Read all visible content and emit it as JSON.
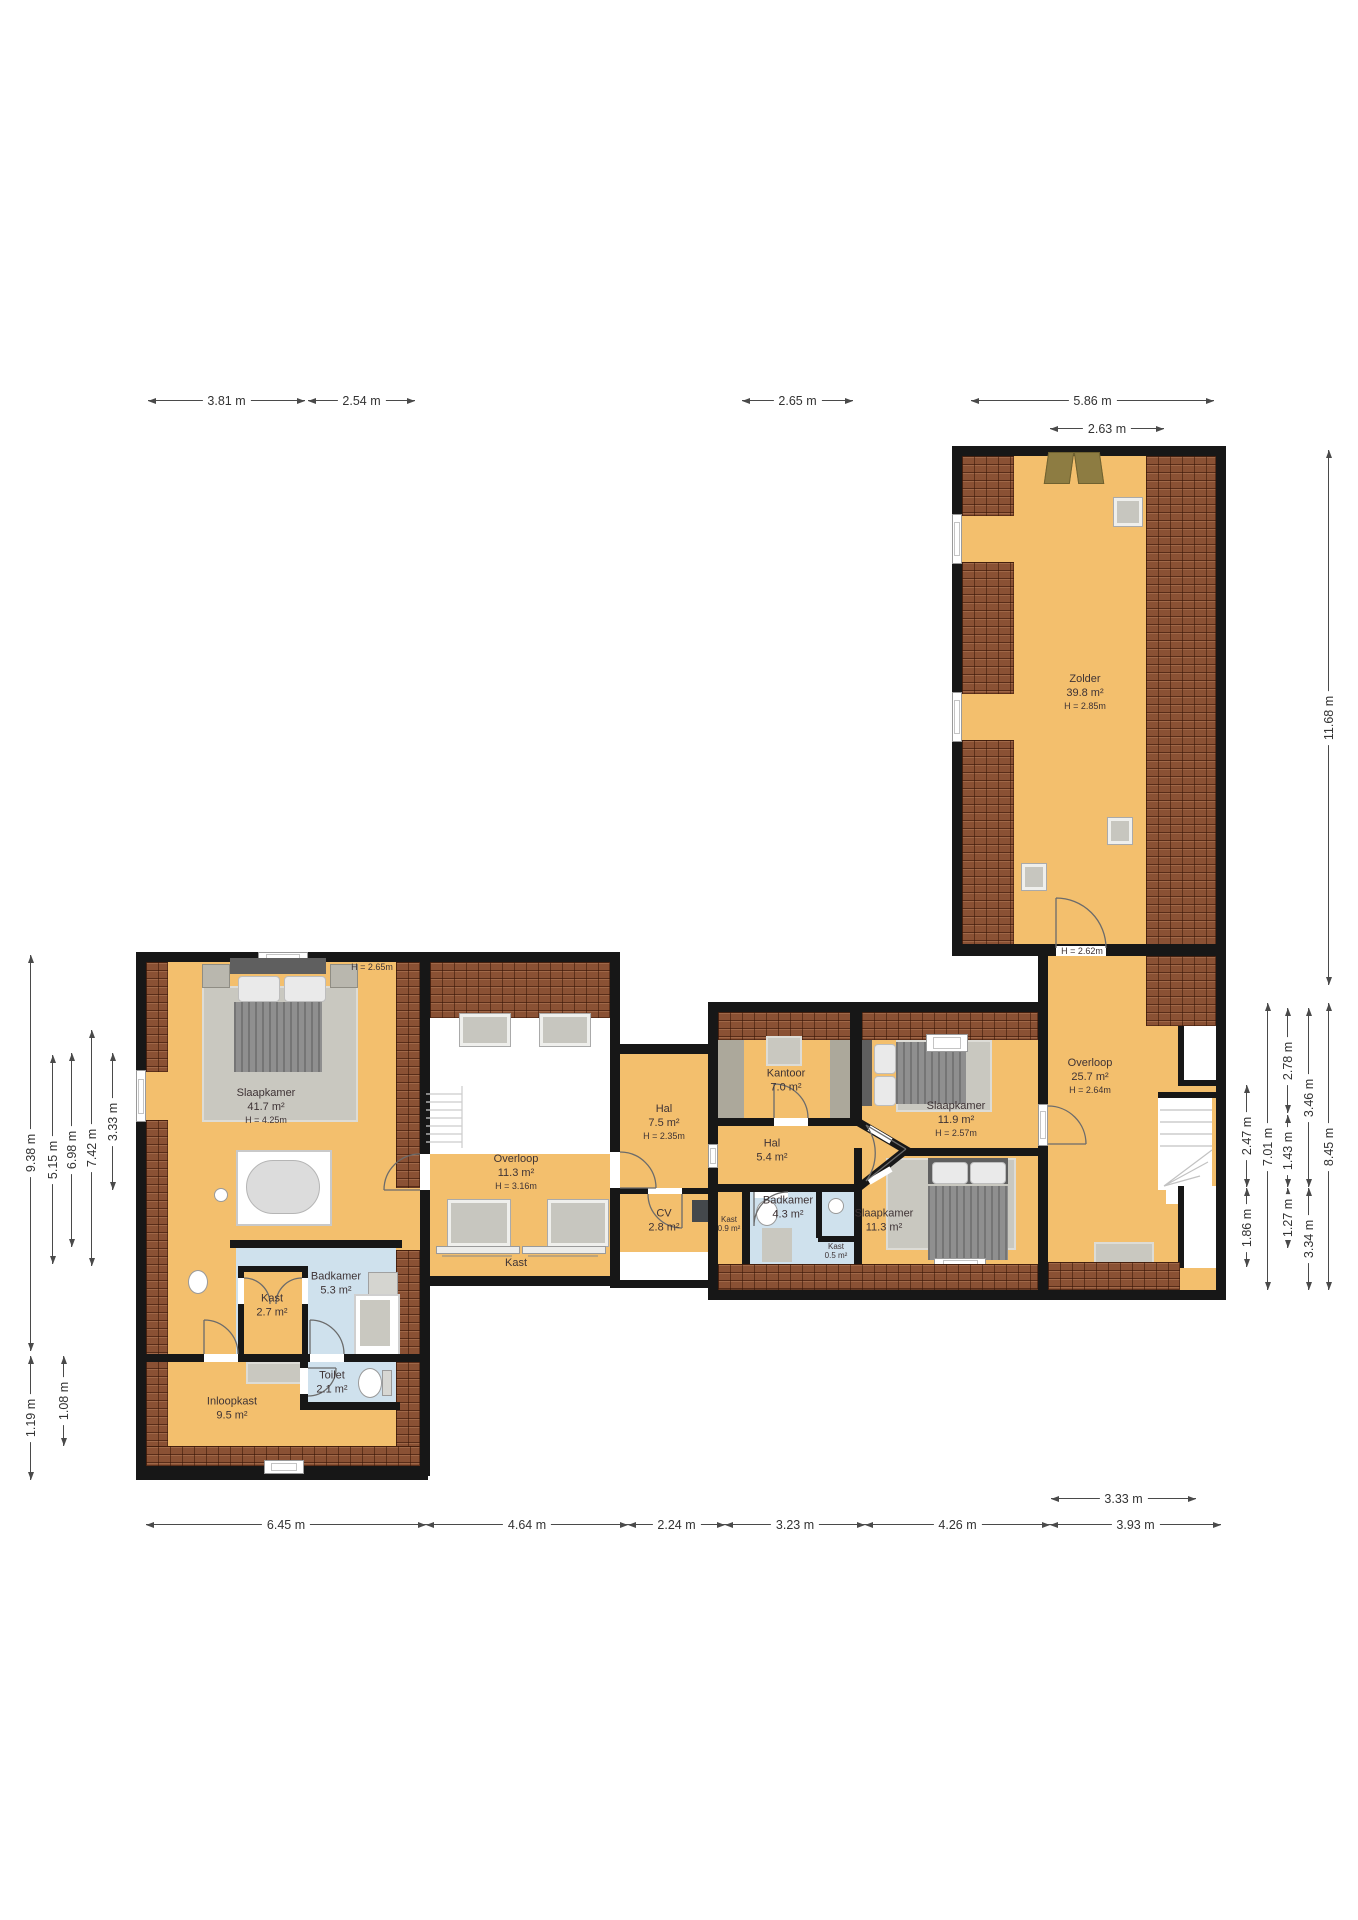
{
  "rooms": {
    "zolder": {
      "name": "Zolder",
      "area": "39.8 m²",
      "h": "H = 2.85m"
    },
    "overloop_groot": {
      "name": "Overloop",
      "area": "25.7 m²",
      "h": "H = 2.64m"
    },
    "slaapkamer_groot": {
      "name": "Slaapkamer",
      "area": "41.7 m²",
      "h": "H = 4.25m"
    },
    "overloop_klein": {
      "name": "Overloop",
      "area": "11.3 m²",
      "h": "H = 3.16m"
    },
    "kast_band": {
      "name": "Kast"
    },
    "hal_boven": {
      "name": "Hal",
      "area": "7.5 m²",
      "h": "H = 2.35m"
    },
    "cv": {
      "name": "CV",
      "area": "2.8 m²"
    },
    "kast_klein": {
      "name": "Kast",
      "area": "0.9 m²"
    },
    "kantoor": {
      "name": "Kantoor",
      "area": "7.0 m²"
    },
    "hal_midden": {
      "name": "Hal",
      "area": "5.4 m²"
    },
    "slaapkamer_119": {
      "name": "Slaapkamer",
      "area": "11.9 m²",
      "h": "H = 2.57m"
    },
    "badkamer_43": {
      "name": "Badkamer",
      "area": "4.3 m²"
    },
    "kast_05": {
      "name": "Kast",
      "area": "0.5 m²"
    },
    "slaapkamer_113": {
      "name": "Slaapkamer",
      "area": "11.3 m²"
    },
    "badkamer_53": {
      "name": "Badkamer",
      "area": "5.3 m²"
    },
    "kast_27": {
      "name": "Kast",
      "area": "2.7 m²"
    },
    "toilet": {
      "name": "Toilet",
      "area": "2.1 m²"
    },
    "inloopkast": {
      "name": "Inloopkast",
      "area": "9.5 m²"
    }
  },
  "free_labels": {
    "h265": "H = 2.65m",
    "h262": "H = 2.62m"
  },
  "dims": {
    "t1": "3.81 m",
    "t2": "2.54 m",
    "t3": "2.65 m",
    "t4": "5.86 m",
    "t5": "2.63 m",
    "b1": "6.45 m",
    "b2": "4.64 m",
    "b3": "2.24 m",
    "b4": "3.23 m",
    "b5": "4.26 m",
    "b6": "3.93 m",
    "b7": "3.33 m",
    "r1": "11.68 m",
    "r2": "8.45 m",
    "r3": "3.46 m",
    "r4": "3.34 m",
    "r5": "2.78 m",
    "r6": "1.43 m",
    "r7": "1.27 m",
    "r8": "2.47 m",
    "r9": "1.86 m",
    "r10": "7.01 m",
    "l1": "9.38 m",
    "l2": "5.15 m",
    "l3": "6.98 m",
    "l4": "7.42 m",
    "l5": "3.33 m",
    "l6": "1.19 m",
    "l7": "1.08 m"
  },
  "colors": {
    "floor": "#F3BF6D",
    "roof": "#8A5134",
    "wall": "#171717",
    "wet_room": "#CFE1ED",
    "furniture": "#8F8F8F"
  }
}
